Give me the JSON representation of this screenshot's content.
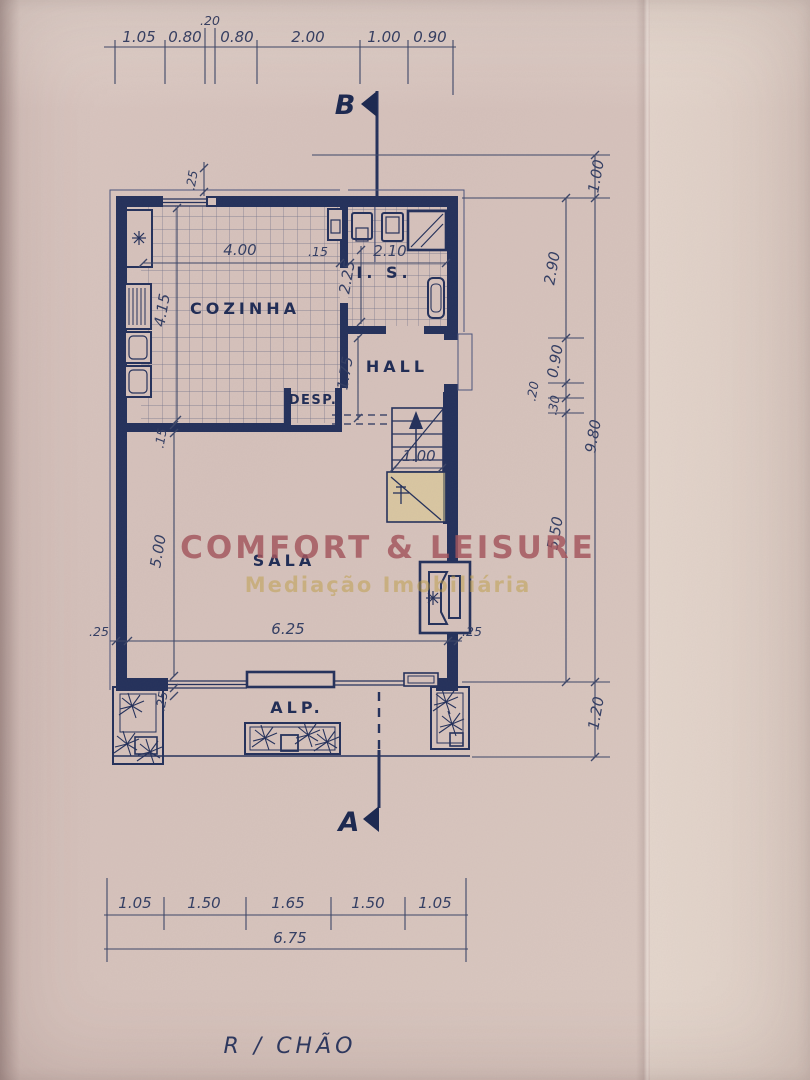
{
  "title": "R / CHÃO",
  "watermark": {
    "line1": "COMFORT & LEISURE",
    "line2": "Mediação Imobiliária"
  },
  "sections": {
    "top": "B",
    "bottom": "A"
  },
  "rooms": {
    "kitchen": "COZINHA",
    "bath": "I. S.",
    "hall": "HALL",
    "pantry": "DESP.",
    "living": "SALA",
    "porch": "ALP."
  },
  "dims": {
    "top1": "1.05",
    "top2": "0.80",
    "top3": ".20",
    "top4": "0.80",
    "top5": "2.00",
    "top6": "1.00",
    "top7": "0.90",
    "b1": "1.05",
    "b2": "1.50",
    "b3": "1.65",
    "b4": "1.50",
    "b5": "1.05",
    "btotal": "6.75",
    "r_out1": "1.00",
    "r_out2": "9.80",
    "r_out3": "1.20",
    "r_in1": "2.90",
    "r_in2": "0.90",
    "r_in3": ".20",
    "r_in4": ".30",
    "r_in5": "5.50",
    "k_w": "4.00",
    "k_h": "4.15",
    "k_wall": ".15",
    "bath_w": "2.10",
    "bath_h": "2.25",
    "hall_h": "1.75",
    "stair_w": "1.00",
    "sala_h": "5.00",
    "sala_wall": ".15",
    "sala_w": "6.25",
    "wall_tl": ".25",
    "wall_l": ".25",
    "wall_r": ".25",
    "wall_bl": ".25"
  },
  "colors": {
    "paper": "#d6c2bc",
    "ink": "#24315b",
    "dim_ink": "#3c4668",
    "watermark_red": "#a4555c",
    "watermark_gold": "#bf9f45",
    "highlight": "#dcca8d"
  }
}
